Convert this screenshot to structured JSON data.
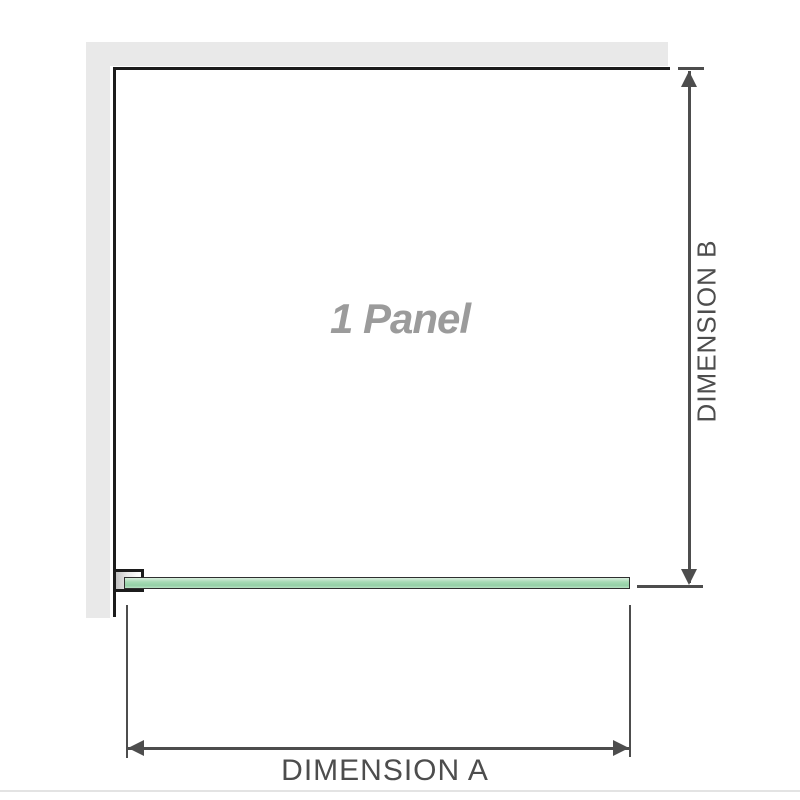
{
  "diagram": {
    "type": "shower-panel-dimension-diagram",
    "panel_label": "1 Panel",
    "dimension_a": {
      "label": "DIMENSION A",
      "orientation": "horizontal",
      "measures": "panel width (glass, wall bracket to outer edge)"
    },
    "dimension_b": {
      "label": "DIMENSION B",
      "orientation": "vertical",
      "measures": "panel height (top edge to glass bottom)"
    },
    "colors": {
      "wall": "#e9e9e9",
      "panel_border": "#1c1c1c",
      "glass_fill": "#a6dab4",
      "glass_highlight": "#d8eedd",
      "glass_border": "#2f2f2f",
      "bracket_border": "#1c1c1c",
      "dimension_line": "#4d4d4d",
      "dimension_text": "#4d4d4d",
      "panel_label_text": "#9b9b9b",
      "baseline": "#e3e3e3"
    }
  }
}
